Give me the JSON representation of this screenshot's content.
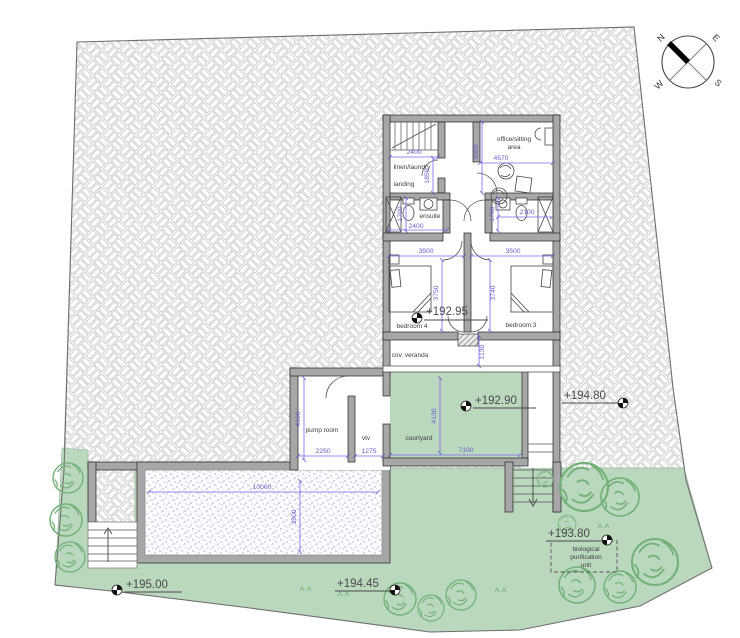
{
  "compass": {
    "n": "N",
    "e": "E",
    "w": "W",
    "s": "S"
  },
  "rooms": {
    "linen_laundry": "linen/laundry",
    "landing": "landing",
    "office_line1": "office/sitting",
    "office_line2": "area",
    "ensuite": "ensuite",
    "bedroom4": "bedroom 4",
    "bedroom3": "bedroom 3",
    "veranda": "cov. veranda",
    "pump_room": "pump room",
    "vtv": "vtv",
    "courtyard": "courtyard",
    "bio_line1": "biological",
    "bio_line2": "purification",
    "bio_line3": "unit"
  },
  "elevations": {
    "upper_floor": "+192.95",
    "courtyard": "+192.90",
    "north_east": "+194.80",
    "bio_unit": "+193.80",
    "south_west": "+195.00",
    "south": "+194.45"
  },
  "dims": {
    "stair_width": "2400",
    "linen_depth": "1850",
    "office_width": "4570",
    "office_depth": "3050",
    "ensuite_left_width": "2400",
    "ensuite_left_depth": "1700",
    "ensuite_right_width": "2100",
    "ensuite_right_depth": "1700",
    "bedroom4_width": "3500",
    "bedroom4_depth": "3750",
    "bedroom3_width": "3500",
    "bedroom3_depth": "3740",
    "veranda_depth": "1130",
    "pump_depth": "4100",
    "pump_width": "2250",
    "hall_width": "1275",
    "courtyard_depth": "4130",
    "courtyard_width": "7100",
    "pool_length": "10000",
    "pool_width": "3500"
  },
  "colors": {
    "lawn": "#b9d8bd",
    "hatch_line": "#c6c6c6",
    "wall": "#a7a7a7",
    "dimension": "#6a5acd",
    "tree": "#74b178"
  }
}
